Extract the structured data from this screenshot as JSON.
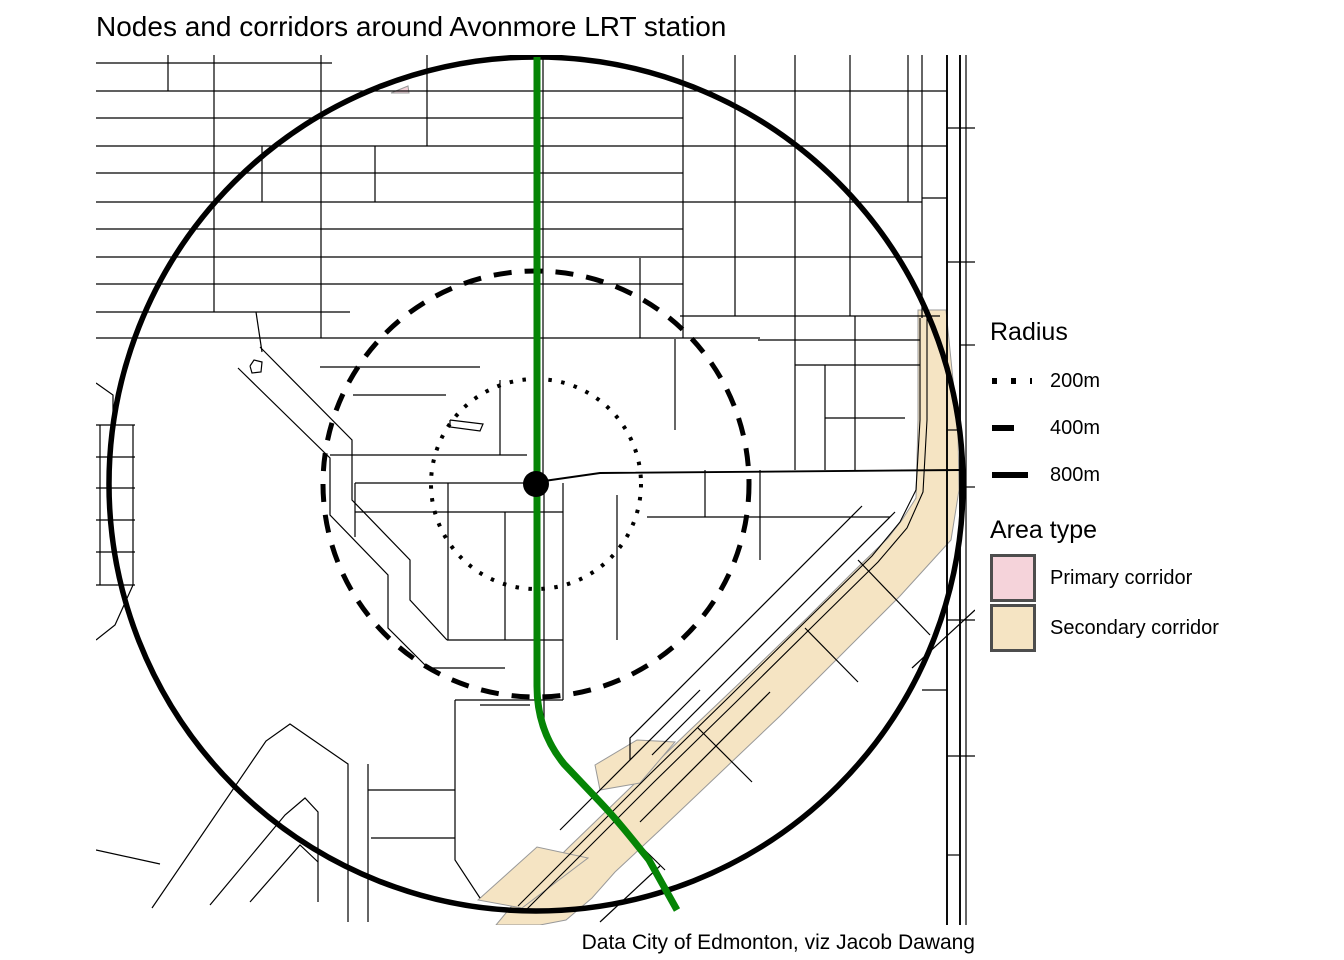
{
  "title": "Nodes and corridors around Avonmore LRT station",
  "caption": "Data City of Edmonton, viz Jacob Dawang",
  "legend": {
    "radius": {
      "title": "Radius",
      "items": [
        {
          "label": "200m",
          "style": "dotted"
        },
        {
          "label": "400m",
          "style": "dashed"
        },
        {
          "label": "800m",
          "style": "solid"
        }
      ]
    },
    "area_type": {
      "title": "Area type",
      "items": [
        {
          "label": "Primary corridor",
          "color": "#f5d3da"
        },
        {
          "label": "Secondary corridor",
          "color": "#f5e4c3"
        }
      ]
    }
  },
  "colors": {
    "lrt_line": "#058505",
    "street": "#000000",
    "circle": "#000000",
    "secondary_fill": "#f5e4c3",
    "primary_fill": "#f5d3da",
    "area_outline": "#999999",
    "swatch_border": "#4d4d4d"
  },
  "map": {
    "station": {
      "name": "Avonmore LRT station",
      "x": 536,
      "y": 484,
      "dot_radius": 13
    },
    "circles": [
      {
        "label": "200m",
        "r": 105,
        "dash": "3.5 9.5",
        "width": 4
      },
      {
        "label": "400m",
        "r": 213,
        "dash": "18 13",
        "width": 5
      },
      {
        "label": "800m",
        "r": 427,
        "dash": "",
        "width": 5.5
      }
    ],
    "lrt_path": "M537,57 L537,686 C537,716 546,742 564,764 L600,802 C618,821 633,840 649,860 L677,910",
    "secondary_polygons": [
      "918,310 946,310 952,370 958,430 959,490 951,540 900,596 840,656 780,716 720,773 660,830 615,872 592,898 566,920 540,925 496,925 520,896 568,848 628,790 688,732 748,675 808,617 852,573 888,538 902,520 916,498 918,420",
      "478,900 537,847 588,858 522,908",
      "595,765 637,740 675,742 640,783 600,790"
    ],
    "primary_polygons": [
      "391,93 408,86 409,93"
    ],
    "railway": [
      "518,906 570,854 648,776 730,696 810,617 872,556 900,522 916,490 920,420 920,318",
      "524,912 576,860 654,782 736,702 816,623 878,562 907,528 923,492 927,420 927,318"
    ],
    "main_streets": [
      "537,482 600,473 960,470",
      "947,55 947,925",
      "960,55 960,925"
    ],
    "streets": [
      "96,63 332,63",
      "96,91 947,91",
      "96,118 683,118",
      "96,146 947,146",
      "96,173 683,173",
      "96,202 922,202",
      "96,229 683,229",
      "96,257 922,257",
      "96,284 683,284",
      "96,312 350,312",
      "680,316 940,316",
      "96,338 760,338",
      "758,340 920,340",
      "214,55 214,312",
      "321,55 321,338",
      "427,55 427,146",
      "375,146 375,202",
      "168,55 168,91",
      "262,146 262,202",
      "543,55 543,480",
      "640,258 640,338",
      "683,55 683,338",
      "735,55 735,316",
      "795,55 795,316",
      "850,55 850,316",
      "908,55 908,202",
      "922,55 922,318",
      "966,55 966,925",
      "947,128 975,128",
      "922,198 947,198",
      "947,262 975,262",
      "960,345 975,345",
      "947,430 960,430",
      "960,487 975,487",
      "947,620 975,620",
      "922,690 947,690",
      "947,756 975,756",
      "947,855 960,855",
      "96,383 113,395 113,425",
      "96,425 135,425",
      "96,457 135,457",
      "96,488 135,488",
      "96,520 135,520",
      "96,552 135,552",
      "96,585 135,585",
      "100,425 100,585",
      "133,425 133,585",
      "133,585 115,625 96,640",
      "96,850 160,864",
      "256,312 262,352",
      "260,347 352,440 352,500 410,560 410,600 447,640",
      "238,368 330,458 330,515 388,575 388,628 428,668",
      "320,367 480,367",
      "353,395 446,395",
      "447,640 563,640",
      "428,668 505,668",
      "250,366 254,360 262,362 261,372 252,373 250,366",
      "450,420 483,424 480,431 450,427 450,420",
      "330,455 527,455",
      "500,380 500,455",
      "355,483 537,483",
      "355,483 355,537",
      "448,483 448,640",
      "505,512 505,640",
      "563,483 563,700",
      "617,495 617,640",
      "355,512 563,512",
      "455,700 563,700",
      "544,483 544,720",
      "480,705 530,705",
      "675,339 675,430",
      "705,470 705,517",
      "647,517 890,517",
      "760,470 760,560",
      "795,316 795,470",
      "855,316 855,470",
      "825,365 825,470",
      "795,365 920,365",
      "825,418 905,418",
      "895,512 652,755",
      "862,506 630,738 630,760",
      "700,690 560,830",
      "770,692 640,822",
      "805,628 858,682",
      "698,728 752,782",
      "612,818 665,870",
      "858,560 930,635",
      "600,922 660,866",
      "912,668 975,610",
      "152,908 266,741 290,724 348,764 348,922",
      "368,764 368,922",
      "210,905 285,815 305,798 318,812 318,902",
      "250,902 300,845 318,862",
      "368,790 455,790",
      "371,838 455,838",
      "455,700 455,860 480,898"
    ]
  }
}
